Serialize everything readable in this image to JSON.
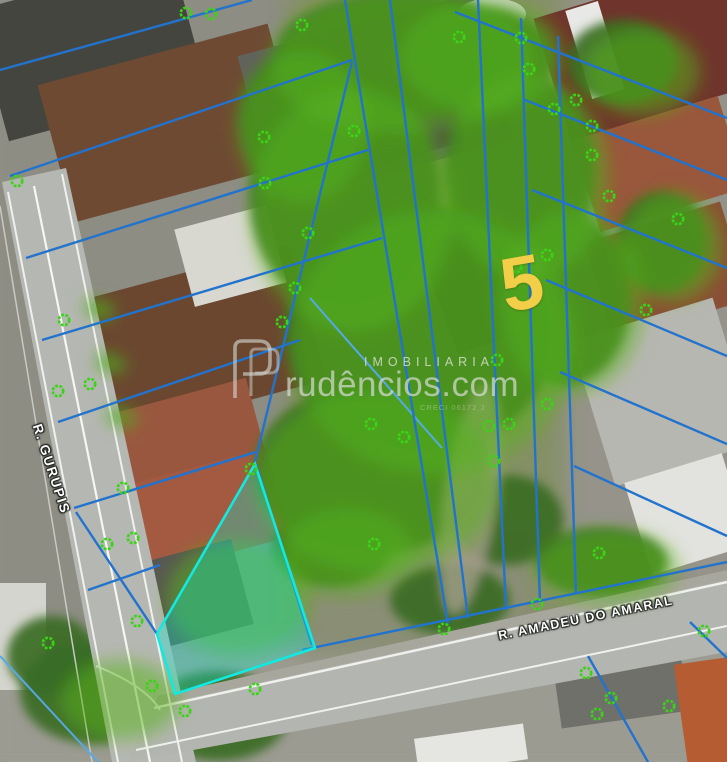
{
  "image": {
    "type": "aerial-property-map",
    "width": 727,
    "height": 762
  },
  "labels": {
    "parcel_number": "5",
    "street_left": "R. GURUPIS",
    "street_bottom": "R. AMADEU DO AMARAL"
  },
  "watermark": {
    "logo_letter": "P",
    "line_top": "IMOBILIARIA",
    "line_main": "rudêncios.com",
    "line_small": "CRECI 06172 J"
  },
  "colors": {
    "parcel_line": "#2273cd",
    "parcel_line_light": "#54a9e6",
    "highlight_stroke": "#12e9e0",
    "highlight_fill": "rgba(10,235,215,0.32)",
    "tree_icon": "#3bd318",
    "parcel_number": "#f2ce49",
    "street_label": "#ffffff"
  },
  "map_annotations": {
    "highlight_polygon": [
      [
        255,
        464
      ],
      [
        315,
        648
      ],
      [
        175,
        694
      ],
      [
        157,
        634
      ]
    ],
    "parcel_lines": [
      [
        0,
        70,
        252,
        0
      ],
      [
        10,
        176,
        352,
        60
      ],
      [
        26,
        258,
        368,
        150
      ],
      [
        42,
        340,
        382,
        238
      ],
      [
        58,
        422,
        300,
        340
      ],
      [
        74,
        508,
        256,
        452
      ],
      [
        88,
        590,
        160,
        565
      ],
      [
        255,
        462,
        352,
        62
      ],
      [
        256,
        464,
        312,
        645
      ],
      [
        157,
        634,
        76,
        512
      ],
      [
        345,
        0,
        448,
        624
      ],
      [
        390,
        0,
        468,
        618
      ],
      [
        478,
        0,
        506,
        610
      ],
      [
        521,
        18,
        540,
        602
      ],
      [
        558,
        36,
        576,
        594
      ],
      [
        455,
        12,
        727,
        118
      ],
      [
        525,
        100,
        727,
        180
      ],
      [
        532,
        190,
        727,
        268
      ],
      [
        546,
        280,
        727,
        356
      ],
      [
        560,
        372,
        727,
        444
      ],
      [
        574,
        466,
        727,
        536
      ],
      [
        302,
        650,
        727,
        562
      ],
      [
        588,
        656,
        648,
        762
      ],
      [
        690,
        622,
        727,
        658
      ]
    ],
    "secondary_lines": [
      [
        0,
        656,
        98,
        762
      ],
      [
        310,
        298,
        442,
        448
      ]
    ],
    "tree_markers": [
      [
        186,
        13
      ],
      [
        211,
        14
      ],
      [
        302,
        25
      ],
      [
        459,
        37
      ],
      [
        521,
        38
      ],
      [
        529,
        69
      ],
      [
        576,
        100
      ],
      [
        554,
        109
      ],
      [
        592,
        126
      ],
      [
        354,
        131
      ],
      [
        264,
        137
      ],
      [
        592,
        155
      ],
      [
        17,
        181
      ],
      [
        265,
        183
      ],
      [
        609,
        196
      ],
      [
        678,
        219
      ],
      [
        308,
        233
      ],
      [
        547,
        255
      ],
      [
        516,
        267
      ],
      [
        295,
        288
      ],
      [
        282,
        322
      ],
      [
        64,
        320
      ],
      [
        646,
        310
      ],
      [
        497,
        360
      ],
      [
        371,
        424
      ],
      [
        404,
        437
      ],
      [
        547,
        404
      ],
      [
        489,
        426
      ],
      [
        509,
        424
      ],
      [
        494,
        461
      ],
      [
        251,
        469
      ],
      [
        123,
        488
      ],
      [
        107,
        544
      ],
      [
        133,
        538
      ],
      [
        374,
        544
      ],
      [
        599,
        553
      ],
      [
        137,
        621
      ],
      [
        537,
        604
      ],
      [
        48,
        643
      ],
      [
        444,
        629
      ],
      [
        152,
        686
      ],
      [
        255,
        689
      ],
      [
        185,
        711
      ],
      [
        586,
        673
      ],
      [
        611,
        698
      ],
      [
        597,
        714
      ],
      [
        669,
        706
      ],
      [
        704,
        631
      ],
      [
        90,
        384
      ],
      [
        58,
        391
      ]
    ]
  }
}
